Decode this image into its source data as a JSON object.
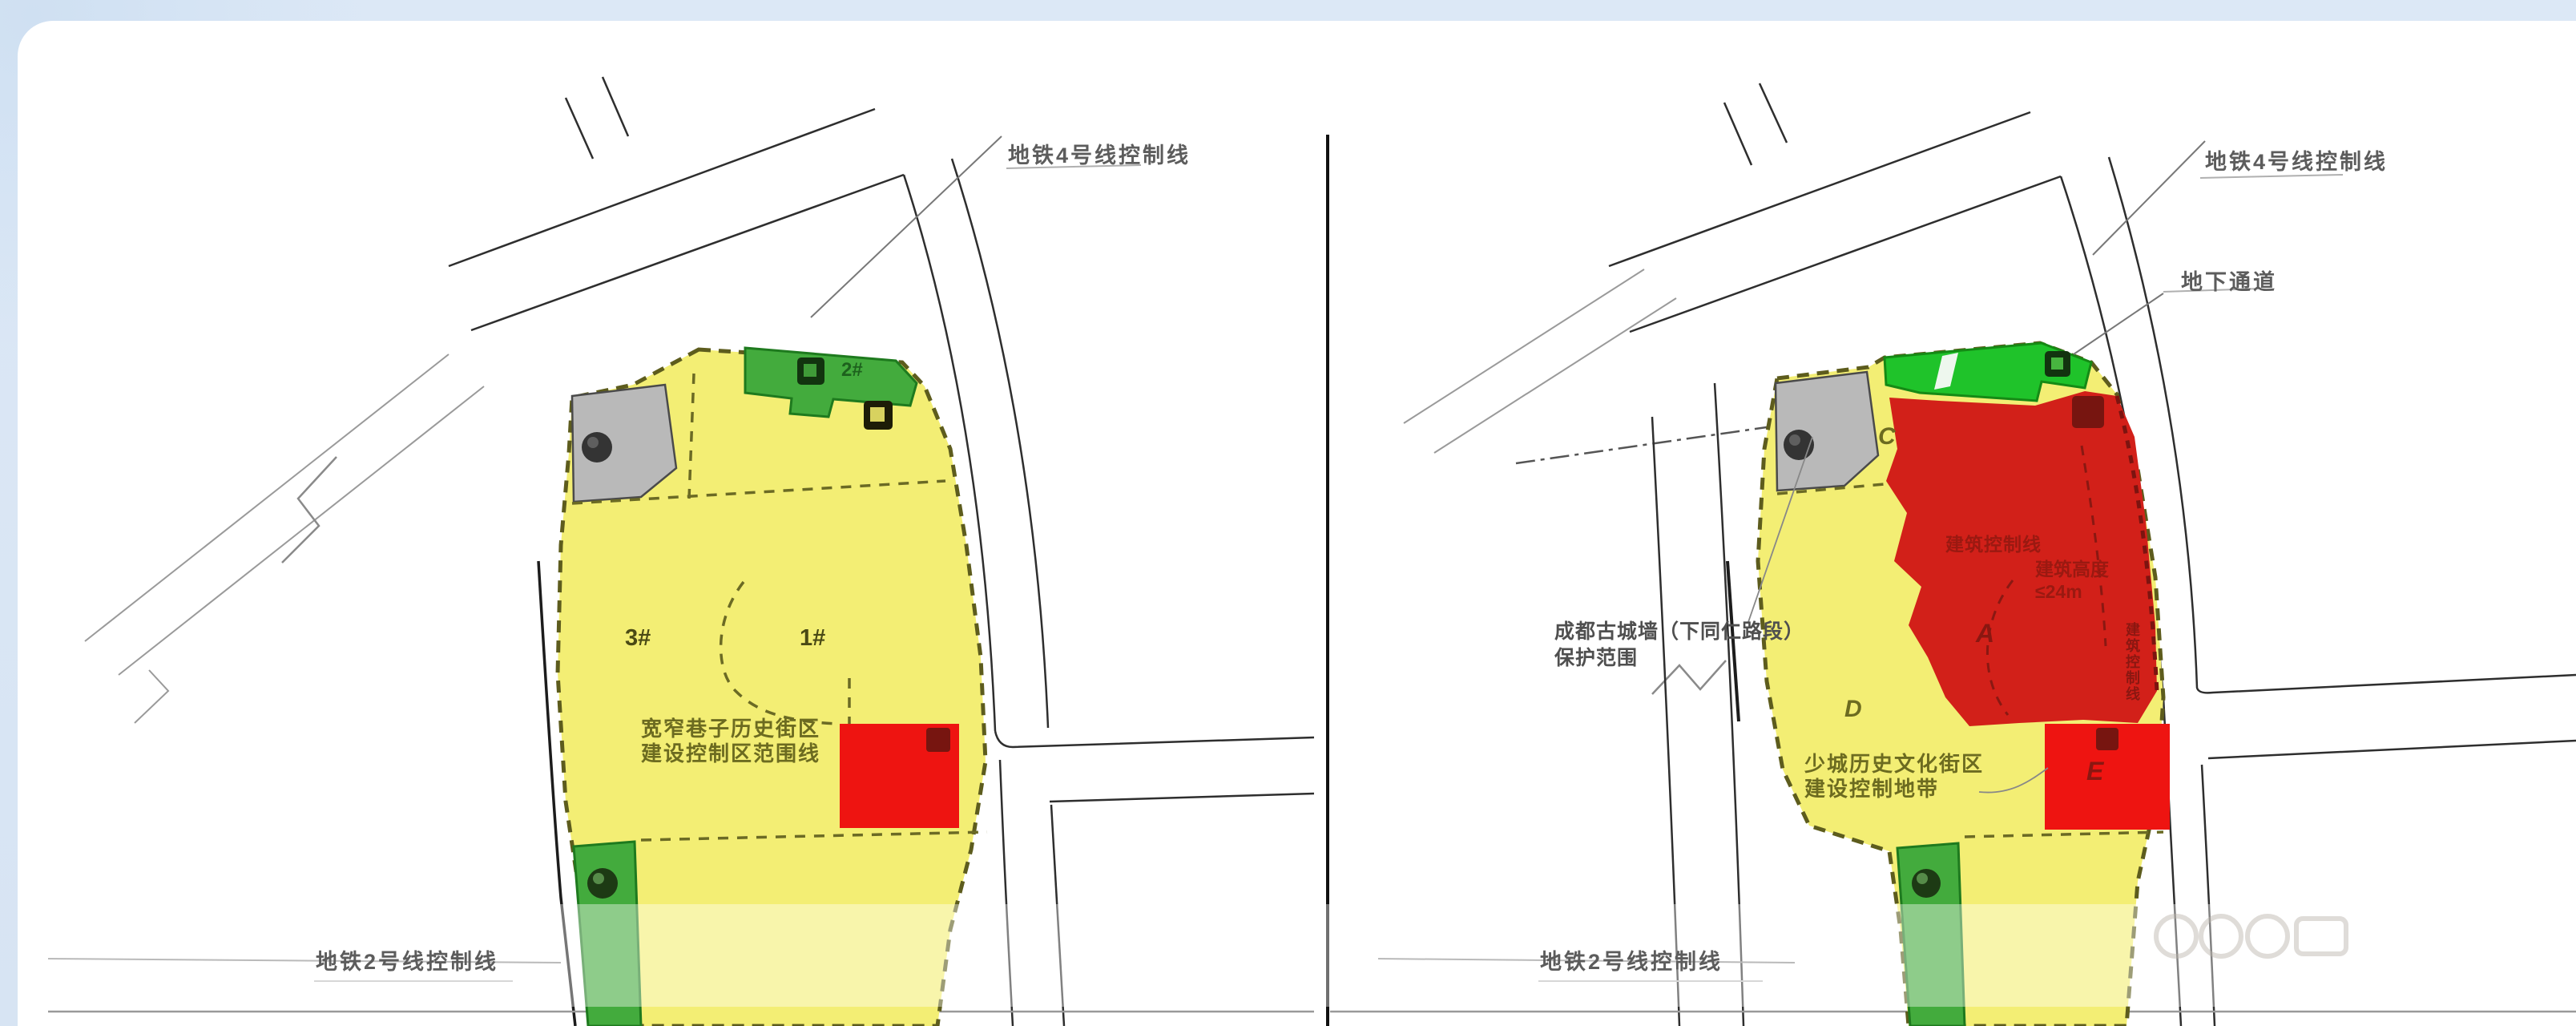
{
  "colors": {
    "background": "#d9e6f4",
    "panel": "#ffffff",
    "site_yellow": "#f3ee74",
    "green_mid": "#43ab3d",
    "green_bright": "#1fc32a",
    "zone_gray": "#b9b9b9",
    "red_bright": "#ee1411",
    "red_zone_a": "#d22019",
    "marker_dark_red": "#771510",
    "site_border_olive": "#5d5c1d",
    "label_gray": "#5c5c5c",
    "label_olive": "#6c6b20",
    "label_dark_green": "#1d611d",
    "label_dark_red": "#9a1911"
  },
  "left_map": {
    "metro4_label": "地铁4号线控制线",
    "metro2_label": "地铁2号线控制线",
    "plot_2": "2#",
    "plot_3": "3#",
    "plot_1": "1#",
    "district_text_line1": "宽窄巷子历史街区",
    "district_text_line2": "建设控制区范围线"
  },
  "right_map": {
    "metro4_label": "地铁4号线控制线",
    "underpass_label": "地下通道",
    "metro2_label": "地铁2号线控制线",
    "wall_text_line1": "成都古城墙（下同仁路段）",
    "wall_text_line2": "保护范围",
    "district_text_line1": "少城历史文化街区",
    "district_text_line2": "建设控制地带",
    "building_control_label": "建筑控制线",
    "height_limit_label": "建筑高度≤24m",
    "edge_control_label": "建筑控制线",
    "zone_a": "A",
    "zone_c": "C",
    "zone_d": "D",
    "zone_e": "E"
  }
}
